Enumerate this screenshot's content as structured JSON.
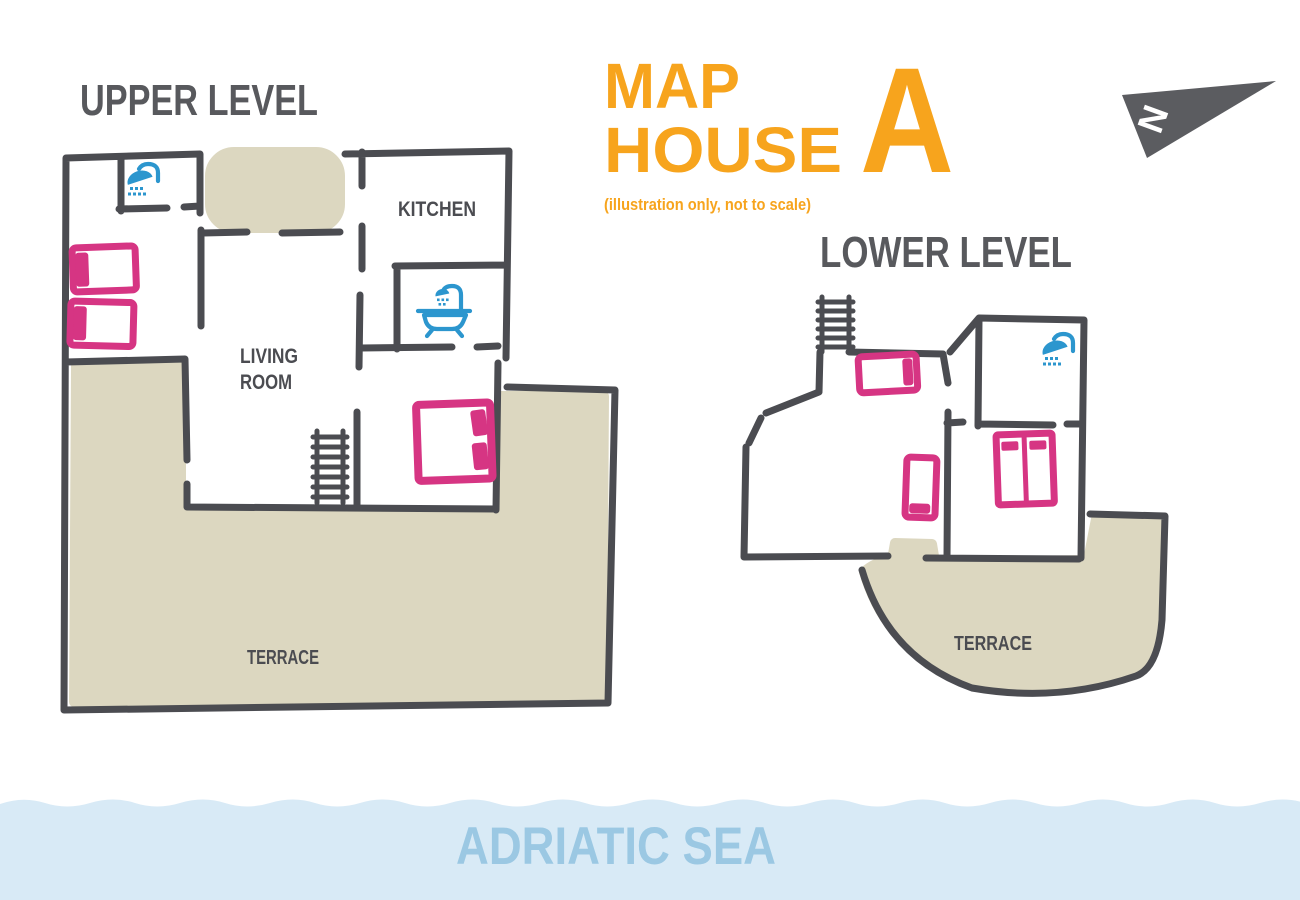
{
  "title": {
    "word1": "MAP",
    "word2": "HOUSE",
    "variant": "A",
    "subtitle": "(illustration only, not to scale)"
  },
  "compass": {
    "label": "N"
  },
  "upper_level": {
    "heading": "UPPER LEVEL",
    "labels": {
      "kitchen": "KITCHEN",
      "living1": "LIVING",
      "living2": "ROOM",
      "terrace": "TERRACE"
    },
    "fixtures": [
      "shower-icon",
      "bathtub-icon",
      "stairs-icon",
      "single-bed-icon",
      "single-bed-icon",
      "double-bed-icon",
      "balcony-area",
      "terrace-area"
    ]
  },
  "lower_level": {
    "heading": "LOWER LEVEL",
    "labels": {
      "terrace": "TERRACE"
    },
    "fixtures": [
      "stairs-icon",
      "shower-icon",
      "single-bed-icon",
      "single-bed-icon",
      "twin-bed-icon",
      "terrace-area"
    ]
  },
  "sea": {
    "label": "ADRIATIC SEA"
  },
  "colors": {
    "wall": "#4b4c51",
    "terrace_fill": "#dcd7c0",
    "bed_pink": "#d63583",
    "fixture_blue": "#2c96ce",
    "title_orange": "#f7a41d",
    "heading_gray": "#58595d",
    "sea_band": "#d8eaf6",
    "sea_text": "#9bc8e3",
    "compass_gray": "#5b5c60"
  }
}
